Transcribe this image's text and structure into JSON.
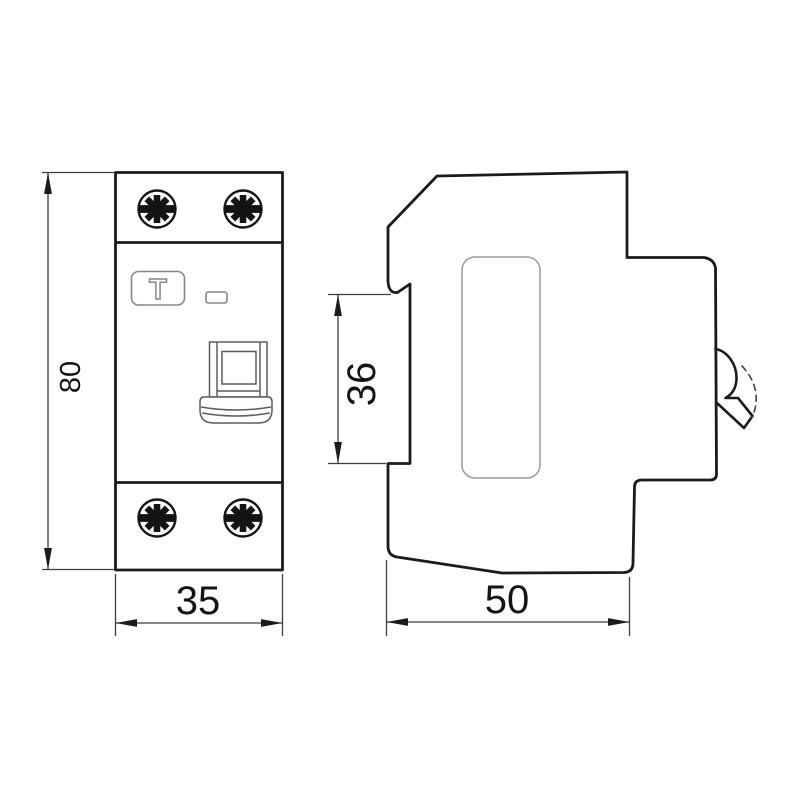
{
  "drawing": {
    "type": "technical-dimension-drawing",
    "subject": "DIN-rail circuit breaker (RCD) outline drawing, front and side views",
    "colors": {
      "background": "#ffffff",
      "outline": "#1b1b1b",
      "detail_gray": "#868686",
      "dimension_lines": "#3d3d3d"
    },
    "front_view": {
      "test_button_label": "T",
      "dim_height": "80",
      "dim_width": "35"
    },
    "side_view": {
      "dim_rail_recess": "36",
      "dim_depth": "50"
    }
  }
}
